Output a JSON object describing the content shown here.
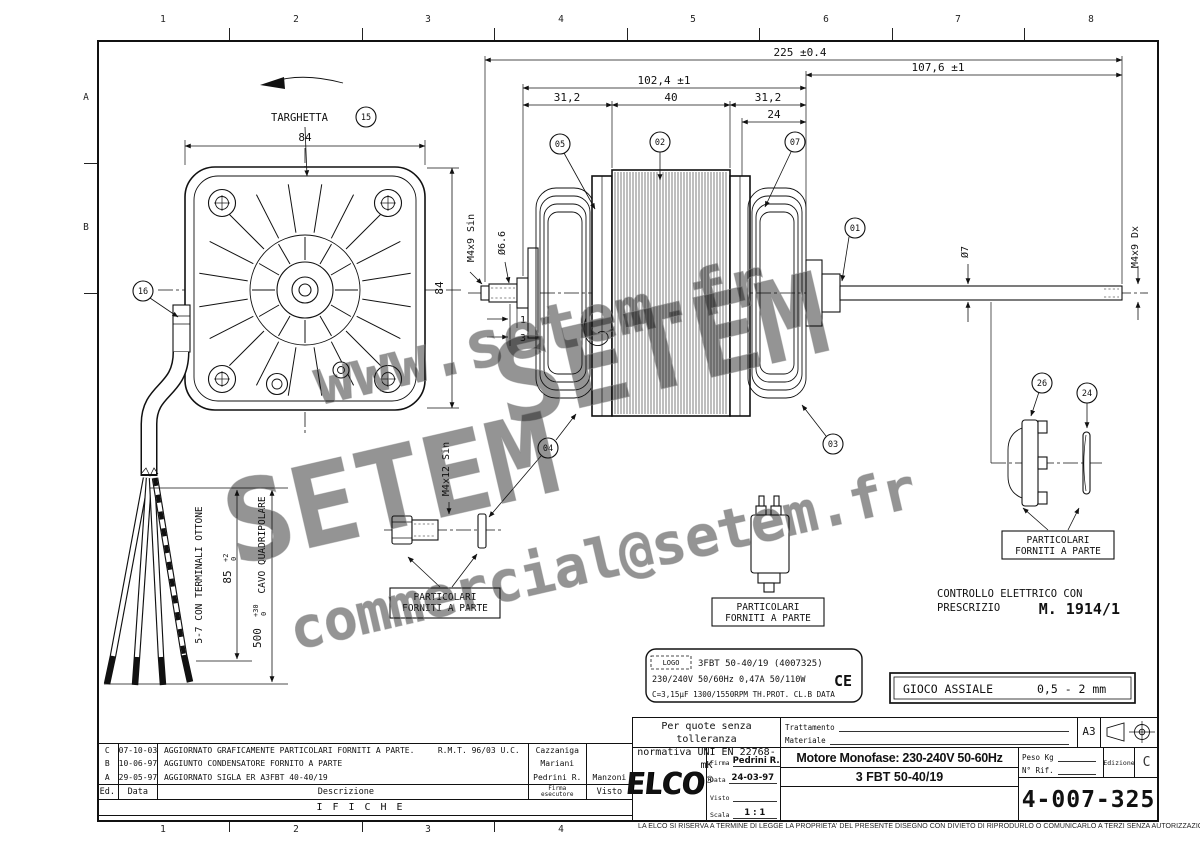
{
  "frame": {
    "top_numbers": [
      "1",
      "2",
      "3",
      "4",
      "5",
      "6",
      "7",
      "8"
    ],
    "bottom_numbers": [
      "1",
      "2",
      "3",
      "4"
    ],
    "row_letters": [
      "A",
      "B"
    ]
  },
  "watermarks": {
    "line1": "www.setem.fr",
    "line2": "SETEM",
    "line3": "SETEM",
    "line4": "commercial@setem.fr"
  },
  "front_view": {
    "targhetta": "TARGHETTA",
    "dim_width": "84",
    "dim_height": "84",
    "note_terminals": "5-7 CON TERMINALI OTTONE",
    "note_cable": "CAVO QUADRIPOLARE",
    "dim_cable_strip": {
      "value": "85",
      "tol_up": "+2",
      "tol_dn": "0"
    },
    "dim_cable_len": {
      "value": "500",
      "tol_up": "+30",
      "tol_dn": "0"
    }
  },
  "side_view": {
    "dim_total": "225 ±0.4",
    "dim_body": "102,4 ±1",
    "dim_right": "107,6 ±1",
    "dim_seg1": "31,2",
    "dim_seg2": "40",
    "dim_seg3": "31,2",
    "dim_24": "24",
    "thread_left": "M4x9 Sin",
    "dia_stub": "Ø6.6",
    "dim_1": "1",
    "dim_3": "3",
    "dia_shaft": "Ø7",
    "thread_right": "M4x9 Dx",
    "screw_label": "M4x12 Sin"
  },
  "balloons": {
    "b01": "01",
    "b02": "02",
    "b03": "03",
    "b04": "04",
    "b05": "05",
    "b07": "07",
    "b15": "15",
    "b16": "16",
    "b24": "24",
    "b26": "26"
  },
  "notes": {
    "particolari1": "PARTICOLARI",
    "particolari2": "FORNITI A PARTE",
    "controllo1": "CONTROLLO ELETTRICO CON",
    "controllo2": "PRESCRIZIO",
    "controllo_ref": "M. 1914/1",
    "gioco_label": "GIOCO ASSIALE",
    "gioco_value": "0,5 - 2 mm"
  },
  "nameplate": {
    "logo": "LOGO",
    "line1": "3FBT 50-40/19  (4007325)",
    "line2": "230/240V  50/60Hz  0,47A  50/110W",
    "ce": "CE",
    "line3": "C=3,15μF  1300/1550RPM  TH.PROT.  CL.B  DATA"
  },
  "title_block": {
    "tolerance_line1": "Per quote senza tolleranza",
    "tolerance_line2": "normativa UNI EN 22768-mK",
    "trattamento_label": "Trattamento",
    "materiale_label": "Materiale",
    "format": "A3",
    "logo": "ELCO",
    "logo_reg": "®",
    "firma_label": "Firma",
    "firma_value": "Pedrini R.",
    "data_label": "Data",
    "data_value": "24-03-97",
    "visto_label": "Visto",
    "visto_value": "",
    "scala_label": "Scala",
    "scala_value": "1 : 1",
    "title_line1": "Motore Monofase: 230-240V 50-60Hz",
    "title_line2": "3 FBT 50-40/19",
    "peso_label": "Peso Kg",
    "rif_label": "N° Rif.",
    "edizione_label": "Edizione",
    "edizione_value": "C",
    "drawing_number": "4-007-325"
  },
  "revision_table": {
    "rows": [
      {
        "ed": "C",
        "date": "07-10-03",
        "desc": "AGGIORNATO GRAFICAMENTE PARTICOLARI FORNITI A PARTE.",
        "ref": "R.M.T. 96/03 U.C.",
        "firma": "Cazzaniga"
      },
      {
        "ed": "B",
        "date": "10-06-97",
        "desc": "AGGIUNTO CONDENSATORE FORNITO A PARTE",
        "ref": "",
        "firma": "Mariani"
      },
      {
        "ed": "A",
        "date": "29-05-97",
        "desc": "AGGIORNATO SIGLA ER A3FBT 40-40/19",
        "ref": "",
        "firma": "Pedrini R."
      }
    ],
    "visto_value": "Manzoni",
    "header": {
      "ed": "Ed.",
      "data": "Data",
      "desc": "Descrizione",
      "firma_line1": "Firma",
      "firma_line2": "esecutore",
      "visto": "Visto"
    },
    "footer": "IFICHE"
  },
  "disclaimer": "LA ELCO SI RISERVA A TERMINE DI LEGGE LA PROPRIETA' DEL PRESENTE DISEGNO CON DIVIETO DI RIPRODURLO O COMUNICARLO A TERZI SENZA AUTORIZZAZIONE"
}
